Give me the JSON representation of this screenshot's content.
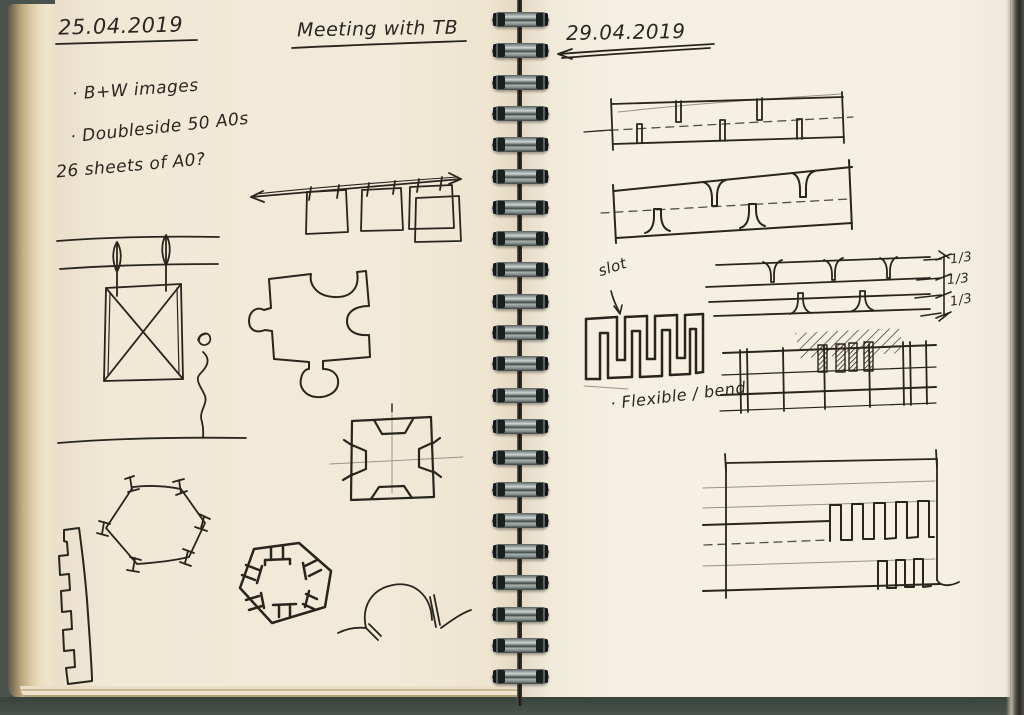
{
  "notebook": {
    "left_page": {
      "date": "25.04.2019",
      "title": "Meeting with TB",
      "notes": [
        "· B+W images",
        "· Doubleside 50 A0s",
        "26 sheets of A0?"
      ]
    },
    "right_page": {
      "date": "29.04.2019",
      "slot_label": "slot",
      "flexible_label": "· Flexible / bend",
      "fractions": [
        "1/3",
        "1/3",
        "1/3"
      ]
    },
    "binding": {
      "ring_count": 22
    },
    "colors": {
      "paper_left": "#f2ead9",
      "paper_right": "#f6f0e2",
      "ink": "#28251d",
      "binding_wire": "#9aa3a1",
      "scan_background": "#49534b"
    }
  }
}
